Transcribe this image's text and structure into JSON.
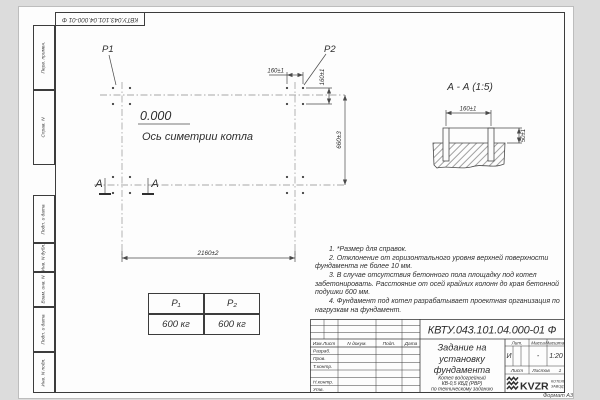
{
  "doc_number": "КВТУ.043.101.04.000-01 Ф",
  "format_label": "Формат А3",
  "margin_stamps": {
    "s1": "Перв. примен.",
    "s2": "Справ. N",
    "s3": "Подп. и дата",
    "s4": "Инв. N дубл.",
    "s5": "Взам. инв. N",
    "s6": "Подп. и дата",
    "s7": "Инв. N подл."
  },
  "plan": {
    "p1": "Р1",
    "p2": "Р2",
    "elevation": "0.000",
    "axis_label": "Ось симетрии котла",
    "section_mark": "А",
    "dim_bolt_spacing_x": "160±1",
    "dim_bolt_spacing_y": "160±1",
    "dim_height": "660±3",
    "dim_width": "2160±2"
  },
  "section_view": {
    "title": "А - А (1:5)",
    "dim_bolt_spacing": "160±1",
    "dim_bolt_height": "50±1"
  },
  "notes": {
    "n1": "1. *Размер для справок.",
    "n2": "2. Отклонение от горизонтального уровня верхней поверхности фундамента не более 10 мм.",
    "n3": "3. В случае отсутствия бетонного пола площадку под котел забетонировать. Расстояние от осей крайних колонн до края бетонной подушки 600 мм.",
    "n4": "4. Фундамент под котел разрабатывает проектная организация по нагрузкам на фундамент."
  },
  "load_table": {
    "h1": "Р₁",
    "h2": "Р₂",
    "v1": "600 кг",
    "v2": "600 кг"
  },
  "title_block": {
    "ch1": "Изм.Лист",
    "ch2": "N докум.",
    "ch3": "Подп.",
    "ch4": "Дата",
    "r1": "Разраб.",
    "r2": "Пров.",
    "r3": "Т.контр.",
    "r5": "Н.контр.",
    "r6": "Утв.",
    "title_l1": "Задание на",
    "title_l2": "установку",
    "title_l3": "фундамента",
    "sub_l1": "Котел водогрейный",
    "sub_l2": "КВ-0,5 КБД (РВР)",
    "sub_l3": "по техническому заданию",
    "lit_label": "Лит.",
    "mass_label": "Масса",
    "scale_label": "Масштаб",
    "lit_value": "И",
    "mass_value": "-",
    "scale_value": "1:20",
    "sheet_label": "Лист",
    "sheets_label": "Листов",
    "sheets_value": "1",
    "logo_text": "KVZR",
    "logo_cap1": "КОТЕЛЬНЫЙ",
    "logo_cap2": "ЗАВОД РЭП",
    "logo_caption_color": "#9c4a32",
    "logo_icon_color": "#2f2f2f"
  }
}
